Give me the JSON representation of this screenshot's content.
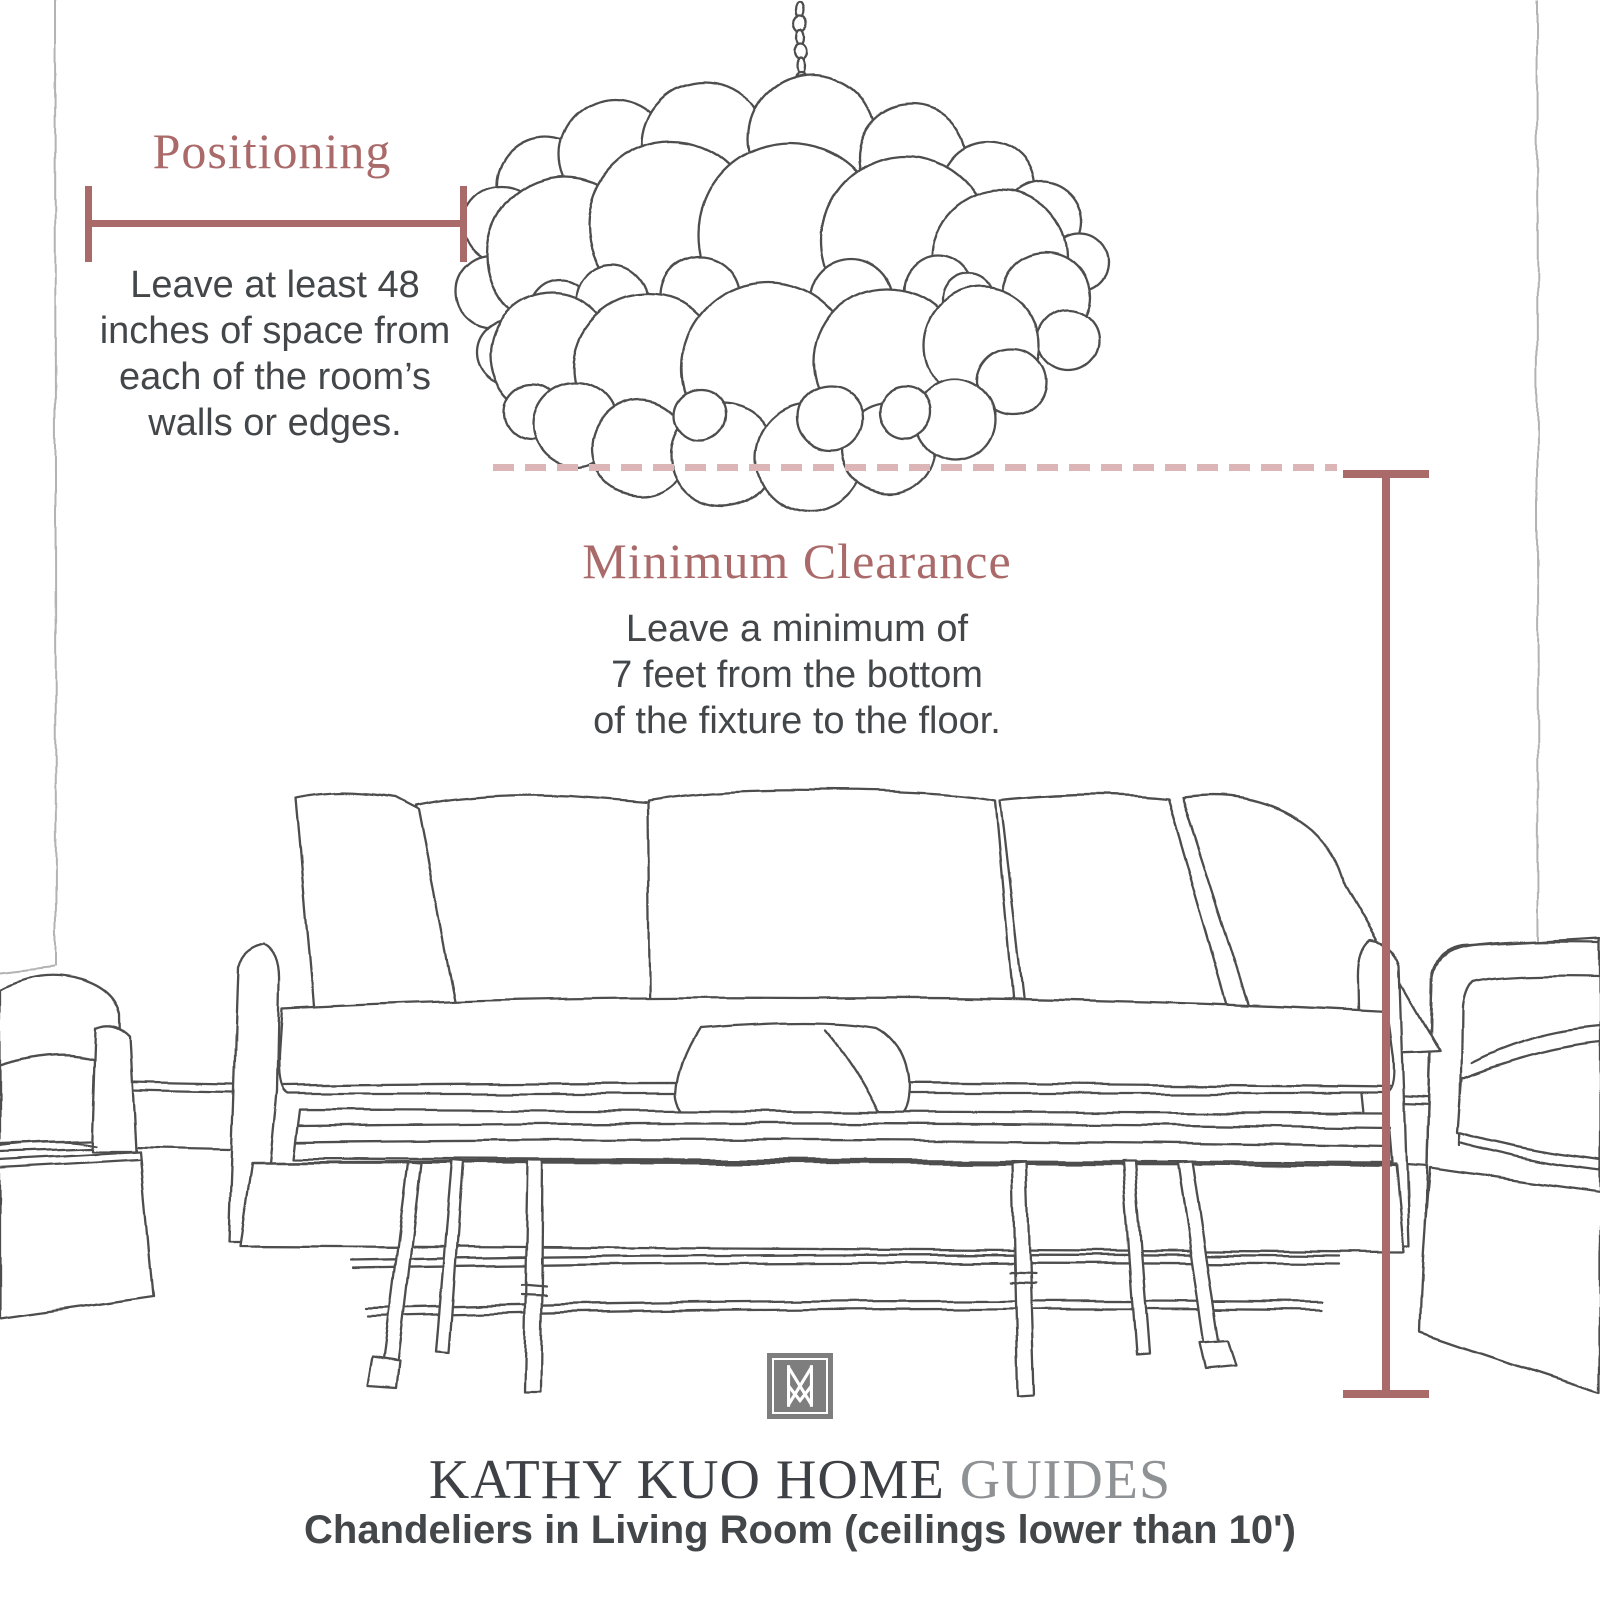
{
  "colors": {
    "accent": "#ab6a6a",
    "accent_light": "#dcb6b6",
    "text": "#43474a",
    "sketch": "#4e4e4e",
    "wall": "#b3b3b3",
    "brand_dark": "#3d4145",
    "brand_light": "#8f9295",
    "logo_gray": "#7e7e7e"
  },
  "positioning": {
    "title": "Positioning",
    "body_lines": [
      "Leave at least 48",
      "inches of space from",
      "each of the room’s",
      "walls or edges."
    ]
  },
  "clearance": {
    "title": "Minimum Clearance",
    "body_lines": [
      "Leave a minimum of",
      "7 feet from the bottom",
      "of the fixture to the floor."
    ]
  },
  "footer": {
    "brand_main": "KATHY KUO HOME",
    "brand_suffix": " GUIDES",
    "subtitle": "Chandeliers in Living Room (ceilings lower than 10')"
  },
  "illustrations": {
    "chandelier": "bubble-chandelier-sketch",
    "sofa": "slipcover-sofa-sketch",
    "bench": "coffee-table-bench-sketch",
    "armchair_left": "armchair-left-sketch",
    "armchair_right": "armchair-right-sketch",
    "walls": "room-corner-wall-lines"
  }
}
